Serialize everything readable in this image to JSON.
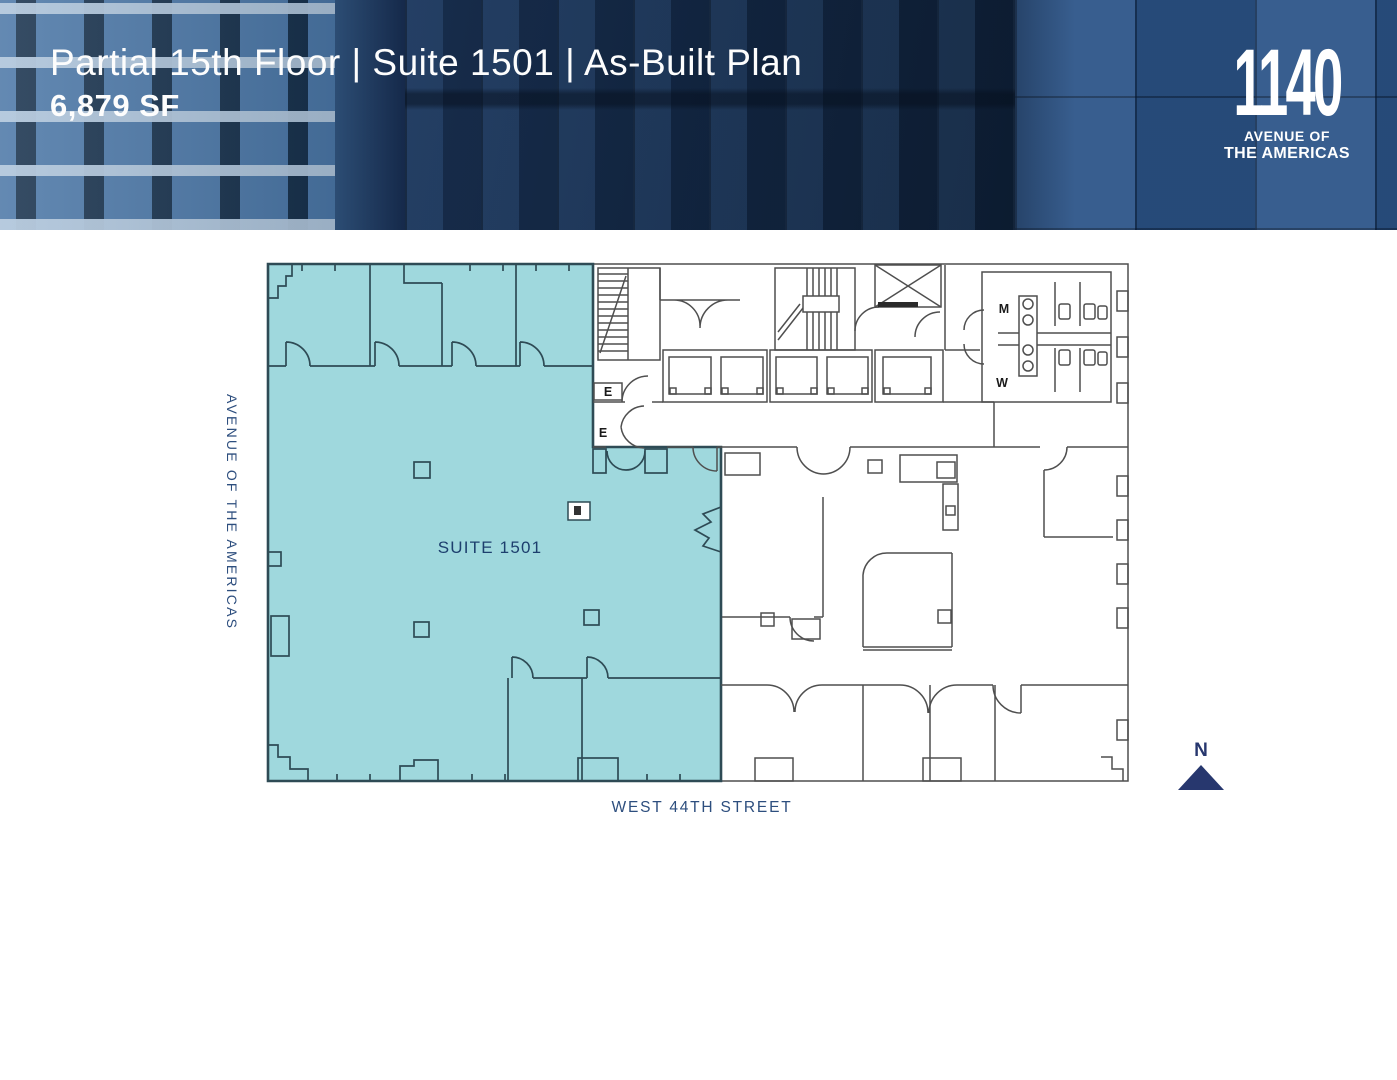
{
  "header": {
    "title": "Partial 15th Floor | Suite 1501 | As-Built Plan",
    "area": "6,879 SF",
    "logo": {
      "number": "1140",
      "line1": "AVENUE OF",
      "line2": "THE AMERICAS"
    }
  },
  "plan": {
    "suite_label": "SUITE 1501",
    "street_label": "WEST 44TH STREET",
    "avenue_label": "AVENUE OF THE AMERICAS",
    "north_label": "N",
    "labels": {
      "stair_elevator": "E",
      "corridor_elevator": "E",
      "mens_room": "M",
      "womens_room": "W"
    }
  },
  "colors": {
    "suite_fill": "#9fd8dd",
    "suite_line": "#2e4b55",
    "wall": "#4f4f4f",
    "label": "#1d3f6e",
    "street": "#2d4e7e",
    "navy": "#27376e"
  }
}
